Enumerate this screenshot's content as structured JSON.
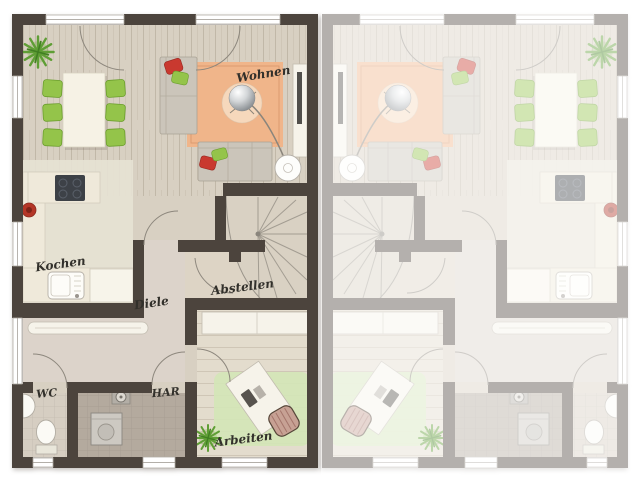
{
  "plan": {
    "type": "duplex-floor-plan",
    "rooms": {
      "wohnen": "Wohnen",
      "kochen": "Kochen",
      "diele": "Diele",
      "abstellen": "Abstellen",
      "wc": "WC",
      "har": "HAR",
      "arbeiten": "Arbeiten"
    },
    "colors": {
      "wall": "#4c443d",
      "floor": "#d8d0c2",
      "kitchenFloor": "#e7e2d4",
      "hallFloor": "#dcd3ca",
      "storeFloor": "#ddd4c5",
      "officeFloor": "#e3dccd",
      "wcFloor": "#d6cec2",
      "harFloor": "#b4aa9e",
      "counter": "#efe9da",
      "chair": "#94c44a",
      "rug": "#f0b58a",
      "officeRug": "#d4e5b7",
      "sofa": "#cbc5ba",
      "pillowRed": "#c9392f",
      "stair": "#d9d1c3",
      "label": "#32302b"
    }
  }
}
